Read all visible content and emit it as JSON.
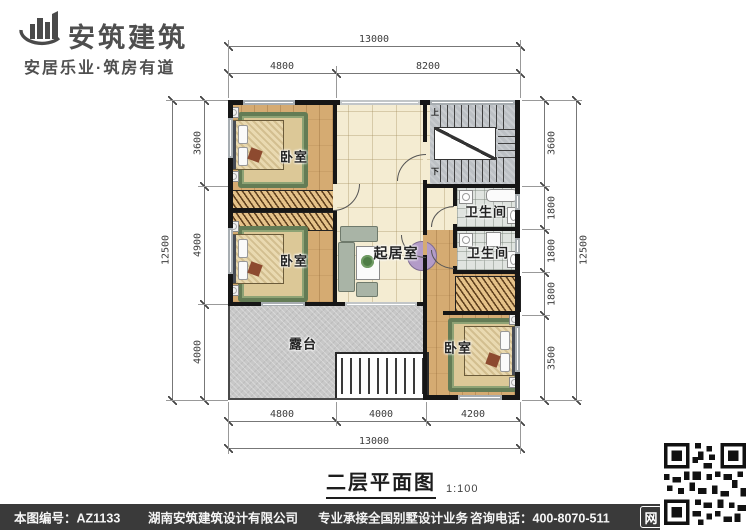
{
  "brand": {
    "name": "安筑建筑",
    "tagline": "安居乐业·筑房有道",
    "logo_icon": "buildings-swoosh-logo"
  },
  "watermark": "安筑建筑",
  "plan": {
    "title": "二层平面图",
    "scale": "1:100",
    "rooms": {
      "bedroom_tl": "卧室",
      "bedroom_ml": "卧室",
      "bedroom_br": "卧室",
      "living": "起居室",
      "bath1": "卫生间",
      "bath2": "卫生间",
      "terrace": "露台"
    },
    "stairs": {
      "up": "上",
      "down": "下"
    },
    "dims": {
      "top_total": "13000",
      "top_seg1": "4800",
      "top_seg2": "8200",
      "bottom_seg1": "4800",
      "bottom_seg2": "4000",
      "bottom_seg3": "4200",
      "bottom_total": "13000",
      "left_total": "12500",
      "left_seg1": "3600",
      "left_seg2": "4900",
      "left_seg3": "4000",
      "right_seg1": "3600",
      "right_seg2": "1800",
      "right_seg3": "1800",
      "right_seg4": "1800",
      "right_seg5": "3500",
      "right_total": "12500"
    }
  },
  "footer": {
    "doc_no": "本图编号：AZ1133",
    "company": "湖南安筑建筑设计有限公司",
    "service": "专业承接全国别墅设计业务",
    "phone": "咨询电话：400-8070-511",
    "web_icon": "网"
  },
  "colors": {
    "wall": "#161616",
    "wood_floor": "#d5ab72",
    "tile_cream": "#f4ecd2",
    "terrace_gray": "#c8c8c8",
    "stair_gray": "#bcc0c4",
    "bath_tile": "#e0e4e0",
    "rug_green": "#647c55",
    "footer_bg": "#3a3a3a"
  }
}
